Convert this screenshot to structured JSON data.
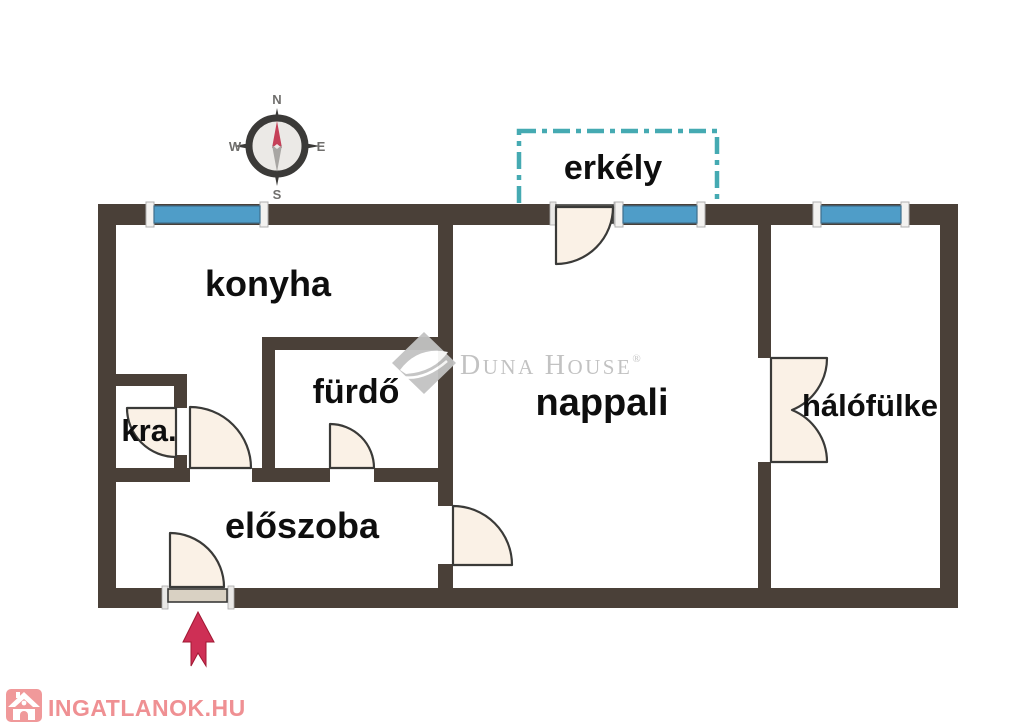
{
  "page": {
    "background": "#ffffff"
  },
  "colors": {
    "wall": "#4a4038",
    "window": "#4f9dc8",
    "window_cap": "#f3f2f0",
    "balcony_dash": "#45aab2",
    "door_fill": "#faf1e6",
    "door_leaf": "#d9d1c3",
    "door_stroke": "#3a3a38",
    "label": "#0e0e0e",
    "arrow": "#ce2f55",
    "compass_dark": "#3b3a38",
    "compass_face": "#ebe9e6",
    "needle_red": "#c54058",
    "needle_gray": "#a8a6a3",
    "watermark_gray": "#bfbfbf",
    "logo_pink": "#f0999a",
    "logo_text_pink": "#ef9093"
  },
  "compass": {
    "n": "N",
    "e": "E",
    "s": "S",
    "w": "W"
  },
  "balcony": {
    "label": "erkély"
  },
  "rooms": {
    "kitchen": "konyha",
    "bathroom": "fürdő",
    "pantry": "kra.",
    "hallway": "előszoba",
    "living_room": "nappali",
    "sleeping_alcove": "hálófülke"
  },
  "watermark": {
    "d": "D",
    "una": "UNA",
    "h": "H",
    "ouse": "OUSE",
    "reg": "®"
  },
  "footer_logo": {
    "text": "INGATLANOK.HU"
  }
}
